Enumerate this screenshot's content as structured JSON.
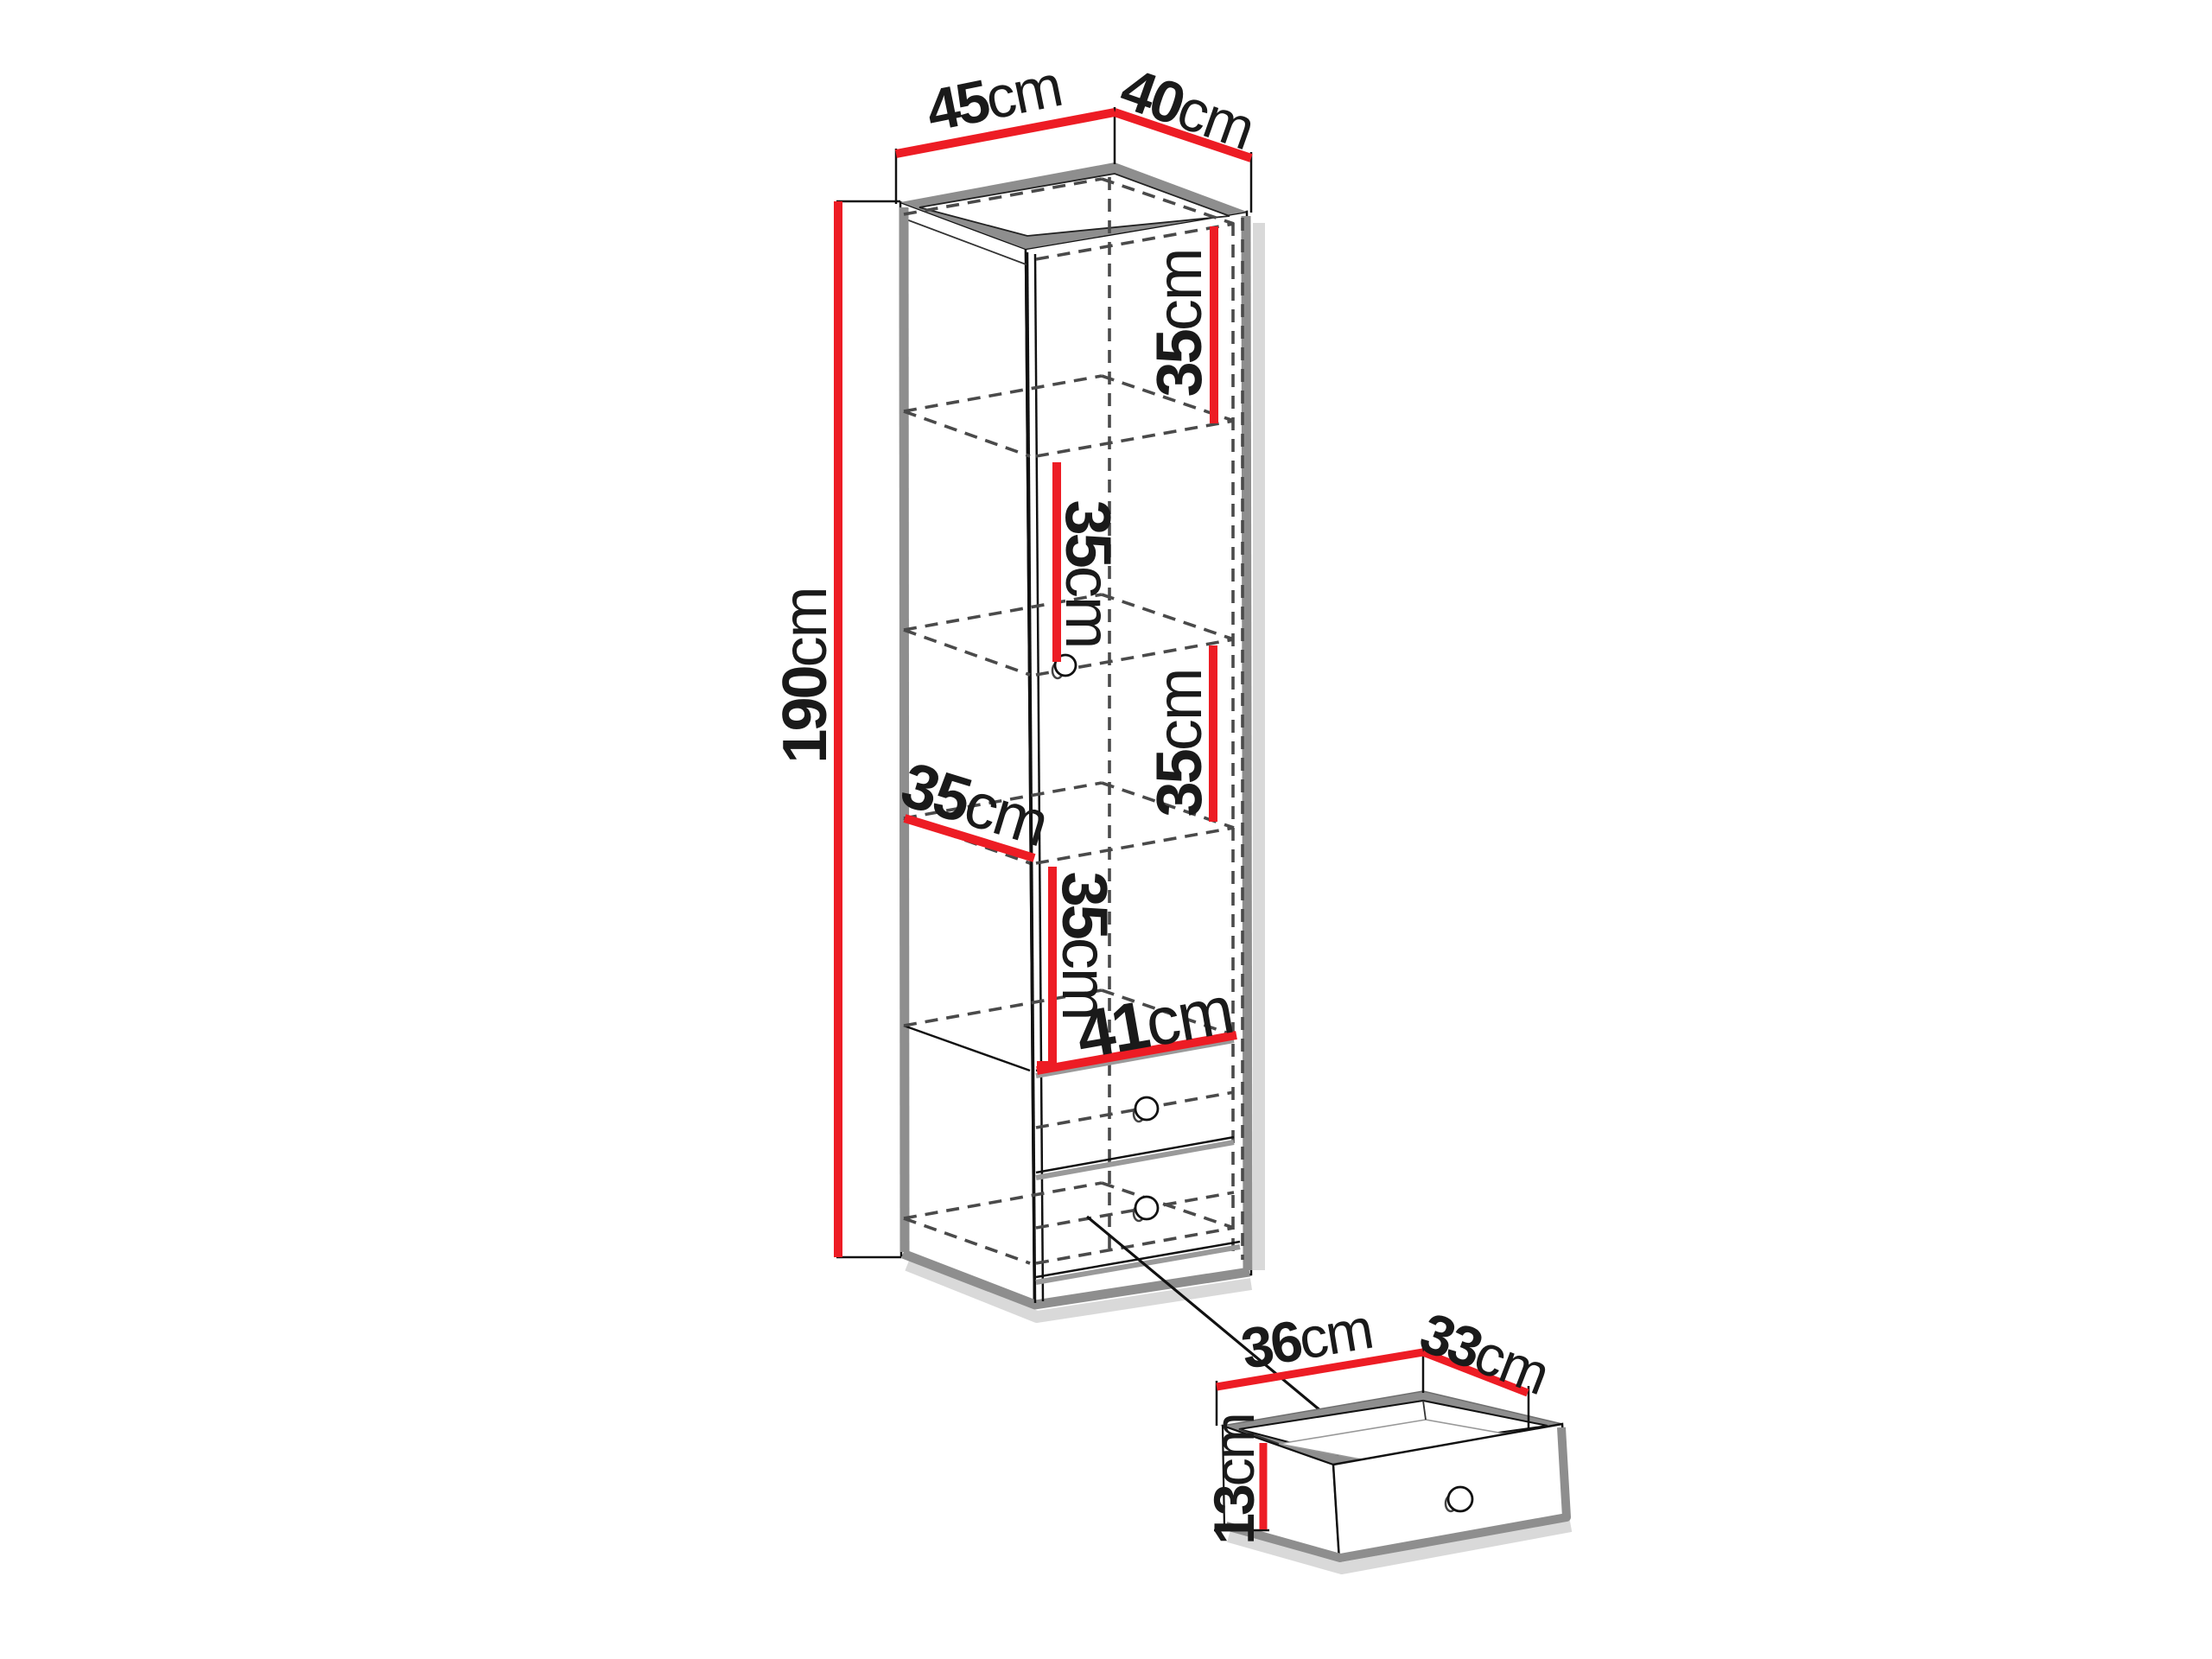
{
  "colors": {
    "accent_red": "#ed1c24",
    "outline_black": "#111111",
    "panel_gray": "#8e8e8e",
    "dash_gray": "#4a4a4a",
    "shadow_gray": "#c9c9c9",
    "background": "#ffffff"
  },
  "dimensions": {
    "top_width": {
      "value": "45",
      "unit": "cm"
    },
    "top_depth": {
      "value": "40",
      "unit": "cm"
    },
    "height": {
      "value": "190",
      "unit": "cm"
    },
    "section_heights": [
      {
        "value": "35",
        "unit": "cm"
      },
      {
        "value": "35",
        "unit": "cm"
      },
      {
        "value": "35",
        "unit": "cm"
      },
      {
        "value": "35",
        "unit": "cm"
      }
    ],
    "shelf_depth": {
      "value": "35",
      "unit": "cm"
    },
    "interior_width": {
      "value": "41",
      "unit": "cm"
    }
  },
  "detail_drawer": {
    "width": {
      "value": "36",
      "unit": "cm"
    },
    "depth": {
      "value": "33",
      "unit": "cm"
    },
    "front_height": {
      "value": "13",
      "unit": "cm"
    }
  }
}
